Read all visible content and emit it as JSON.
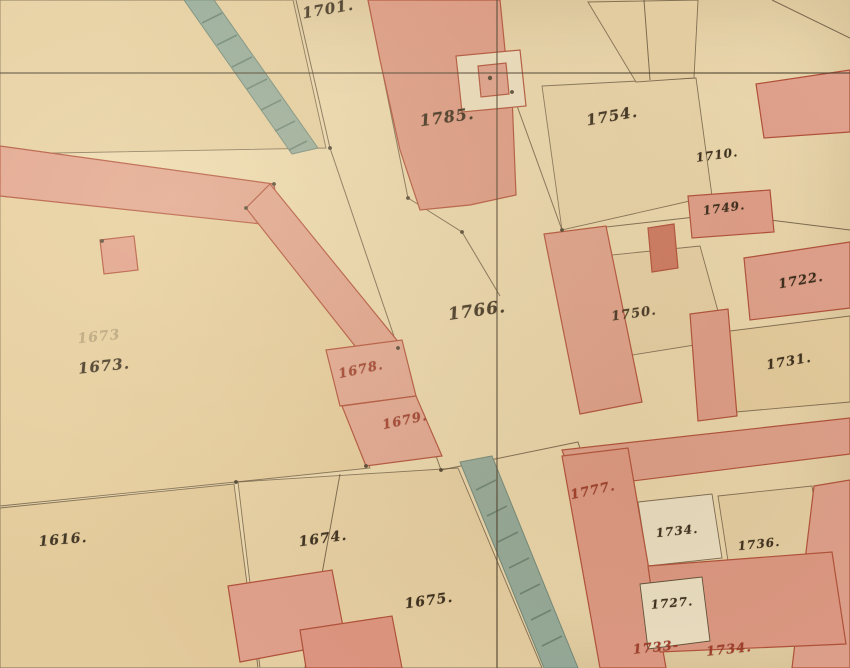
{
  "map": {
    "title": "historical-cadastral-map-sheet",
    "colors": {
      "paper_road": "#eedbb2",
      "field_tan": "#e5cd9e",
      "building_pink": "#e09a8a",
      "building_pink_dark": "#d98a78",
      "building_outline_carmine": "#a83a28",
      "courtyard_white": "#efe7cf",
      "stream_blue_green": "#87a59b",
      "stream_hatch_dark": "#56786f",
      "ink_black": "#2e2416",
      "ink_red": "#9e3526",
      "boundary_line": "#473827"
    },
    "features": {
      "stream_count": 2,
      "survey_crosshair": "horizontal and vertical fine section lines",
      "building_fill": "pink masonry wash",
      "parcel_fill": "tan field wash"
    },
    "labels": [
      {
        "text": "1701.",
        "x": 328,
        "y": 9,
        "ink": "black",
        "size": 15,
        "rot": -10,
        "opacity": 0.9
      },
      {
        "text": "1785.",
        "x": 447,
        "y": 117,
        "ink": "black",
        "size": 16,
        "rot": -8,
        "opacity": 0.95
      },
      {
        "text": "1754.",
        "x": 612,
        "y": 116,
        "ink": "black",
        "size": 15,
        "rot": -10,
        "opacity": 0.95
      },
      {
        "text": "1710.",
        "x": 717,
        "y": 155,
        "ink": "black",
        "size": 12,
        "rot": -8,
        "opacity": 0.95
      },
      {
        "text": "1749.",
        "x": 724,
        "y": 208,
        "ink": "black",
        "size": 12,
        "rot": -8,
        "opacity": 0.95
      },
      {
        "text": "1722.",
        "x": 801,
        "y": 281,
        "ink": "black",
        "size": 13,
        "rot": -10,
        "opacity": 0.95
      },
      {
        "text": "1766.",
        "x": 477,
        "y": 311,
        "ink": "black",
        "size": 17,
        "rot": -8,
        "opacity": 0.95
      },
      {
        "text": "1750.",
        "x": 634,
        "y": 314,
        "ink": "black",
        "size": 13,
        "rot": -8,
        "opacity": 0.9
      },
      {
        "text": "1731.",
        "x": 789,
        "y": 362,
        "ink": "black",
        "size": 13,
        "rot": -10,
        "opacity": 0.95
      },
      {
        "text": "1673",
        "x": 99,
        "y": 337,
        "ink": "black",
        "size": 14,
        "rot": -6,
        "opacity": 0.25
      },
      {
        "text": "1673.",
        "x": 104,
        "y": 366,
        "ink": "black",
        "size": 15,
        "rot": -6,
        "opacity": 0.9
      },
      {
        "text": "1678.",
        "x": 361,
        "y": 370,
        "ink": "red",
        "size": 13,
        "rot": -12,
        "opacity": 0.95
      },
      {
        "text": "1679.",
        "x": 405,
        "y": 421,
        "ink": "red",
        "size": 13,
        "rot": -12,
        "opacity": 0.95
      },
      {
        "text": "1616.",
        "x": 63,
        "y": 540,
        "ink": "black",
        "size": 14,
        "rot": -5,
        "opacity": 0.9
      },
      {
        "text": "1674.",
        "x": 323,
        "y": 539,
        "ink": "black",
        "size": 14,
        "rot": -8,
        "opacity": 0.95
      },
      {
        "text": "1675.",
        "x": 429,
        "y": 601,
        "ink": "black",
        "size": 14,
        "rot": -8,
        "opacity": 0.95
      },
      {
        "text": "1777.",
        "x": 593,
        "y": 491,
        "ink": "red",
        "size": 13,
        "rot": -12,
        "opacity": 0.95
      },
      {
        "text": "1734.",
        "x": 677,
        "y": 531,
        "ink": "black",
        "size": 12,
        "rot": -6,
        "opacity": 0.95
      },
      {
        "text": "1736.",
        "x": 759,
        "y": 544,
        "ink": "black",
        "size": 12,
        "rot": -6,
        "opacity": 0.95
      },
      {
        "text": "1727.",
        "x": 672,
        "y": 603,
        "ink": "black",
        "size": 12,
        "rot": -5,
        "opacity": 0.95
      },
      {
        "text": "1733-",
        "x": 656,
        "y": 648,
        "ink": "red",
        "size": 13,
        "rot": -6,
        "opacity": 0.95
      },
      {
        "text": "1734.",
        "x": 729,
        "y": 650,
        "ink": "red",
        "size": 13,
        "rot": -6,
        "opacity": 0.95
      }
    ]
  }
}
